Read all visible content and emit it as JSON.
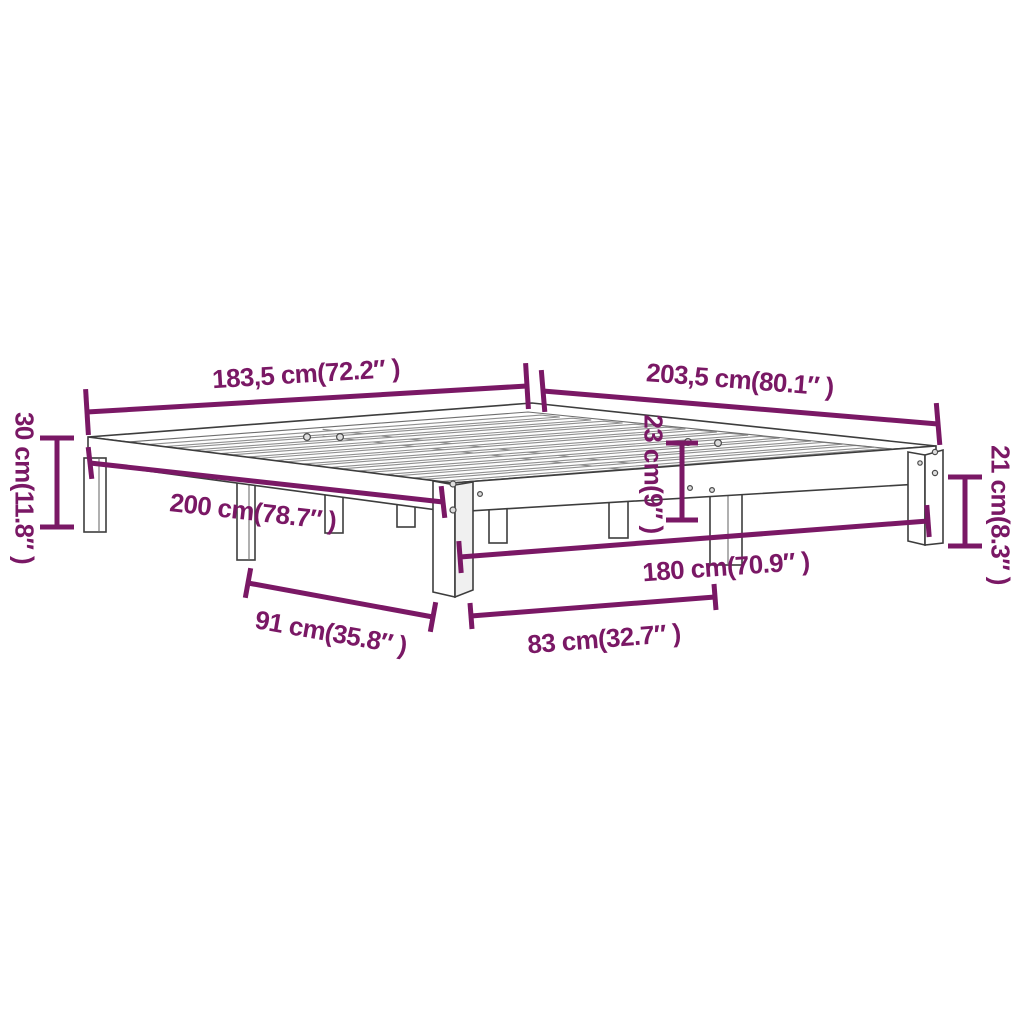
{
  "diagram": {
    "accent_color": "#7a1865",
    "outline_color": "#3d3d3d",
    "background_color": "#ffffff",
    "labels": {
      "overall_width": "183,5 cm(72.2″ )",
      "overall_length": "203,5 cm(80.1″ )",
      "height_left": "30 cm(11.8″ )",
      "side_length": "200 cm(78.7″ )",
      "under_slat_height": "23 cm(9″ )",
      "rail_height": "21 cm(8.3″ )",
      "inner_width": "180 cm(70.9″ )",
      "leg_span_side": "91 cm(35.8″ )",
      "leg_span_front": "83 cm(32.7″ )"
    }
  }
}
